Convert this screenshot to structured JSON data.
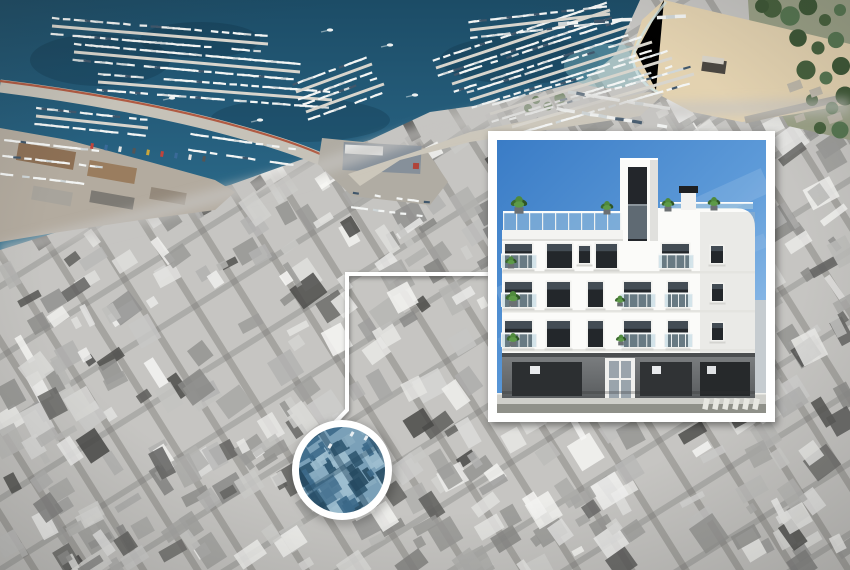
{
  "scene": {
    "description": "Aerial photo of a Mediterranean coastal town: colored marina and beach at top, grayscale city below, with a location-highlight circle connected by a white line to a framed architectural render of a new white apartment building",
    "width_px": 850,
    "height_px": 570
  },
  "map": {
    "marina_label": "harbor marina with docks and boats",
    "beach_label": "sand beach with promenade and trees",
    "city_label": "grayscale city blocks with diagonal streets",
    "port_label": "port quay with warehouses and breakwater"
  },
  "callout": {
    "circle_label": "location highlight circle (blue tinted aerial detail)",
    "connector_label": "white connector line from circle to inset",
    "inset_label": "architectural render inset of apartment building",
    "building": {
      "style": "modern white apartment building",
      "floors_visible": 4,
      "features": [
        "roof terrace with glass railing and plants",
        "elevator tower with dark glazing",
        "chimney",
        "balconies with glass railings",
        "dark framed windows",
        "stone-clad ground floor",
        "glass entrance door",
        "sidewalk and road with crosswalk",
        "blue sky"
      ]
    }
  },
  "palette": {
    "water_deep": "#1e506b",
    "water_mid": "#2e6d89",
    "water_light": "#6fa8b8",
    "sand": "#e0d0ae",
    "tree_green": "#4e6b41",
    "city_gray": "#c6c5c2",
    "highlight_tint": "#5b84a0",
    "frame_white": "#ffffff",
    "sky_blue": "#4287cf",
    "window_dark": "#23272b",
    "ground_floor_gray": "#6a6d6e",
    "road_gray": "#8f9089",
    "plant_green": "#4f8a3c"
  }
}
